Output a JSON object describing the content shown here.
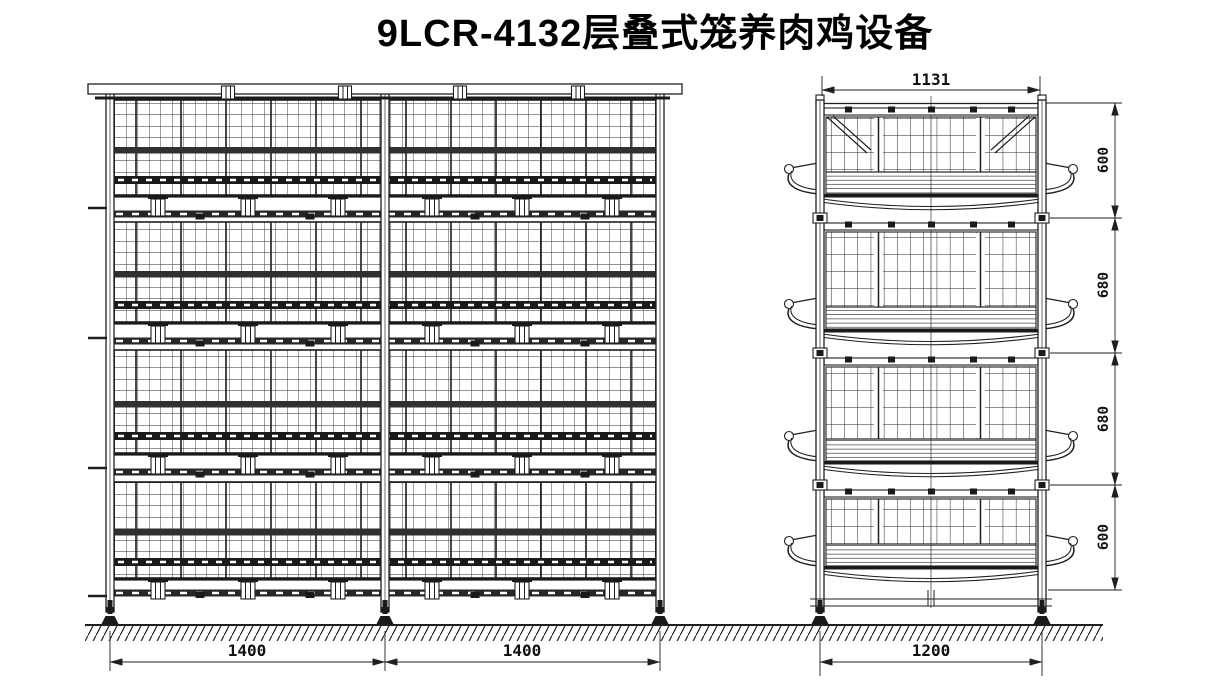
{
  "title": "9LCR-4132层叠式笼养肉鸡设备",
  "views": {
    "front": {
      "bay_width_dims": [
        "1400",
        "1400"
      ]
    },
    "side": {
      "top_width_dim": "1131",
      "bottom_width_dim": "1200",
      "tier_height_dims": [
        "600",
        "680",
        "680",
        "600"
      ]
    }
  },
  "colors": {
    "line": "#1f1f1f",
    "background": "#ffffff"
  }
}
